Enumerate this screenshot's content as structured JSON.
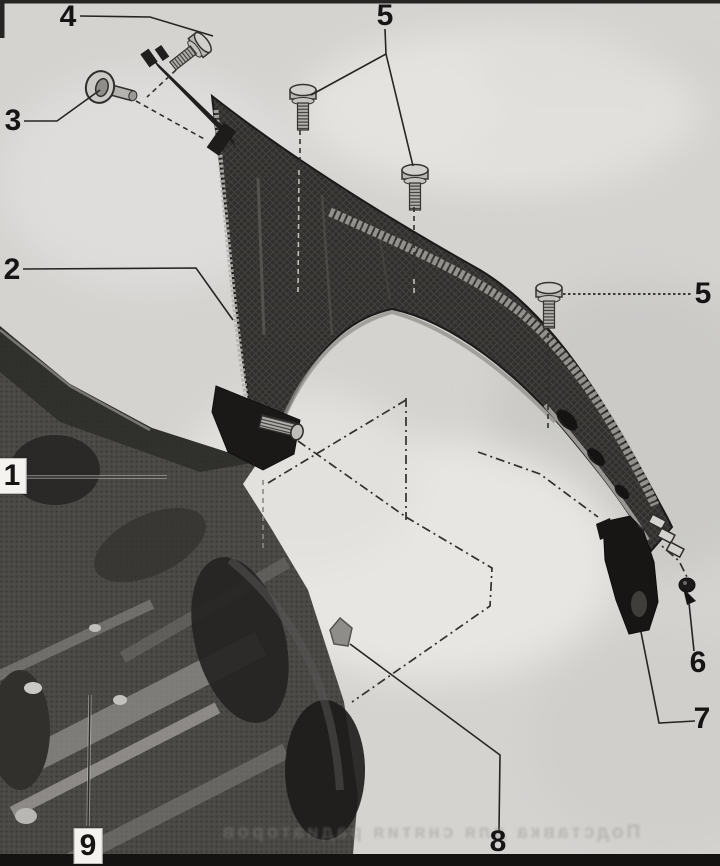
{
  "figure": {
    "type": "exploded-diagram",
    "subject": "Front fender (wing) mounting — scanned repair-manual illustration",
    "callouts": [
      {
        "label": "4"
      },
      {
        "label": "3"
      },
      {
        "label": "5"
      },
      {
        "label": "2"
      },
      {
        "label": "5"
      },
      {
        "label": "1"
      },
      {
        "label": "6"
      },
      {
        "label": "7"
      },
      {
        "label": "8"
      },
      {
        "label": "9"
      }
    ],
    "bleed_text": "Подставка для снятия радиаторов"
  },
  "colors": {
    "paper": "#d4d3d0",
    "ink": "#161514",
    "fender_dark": "#302f2c",
    "photo_gray": "#4b4946"
  }
}
